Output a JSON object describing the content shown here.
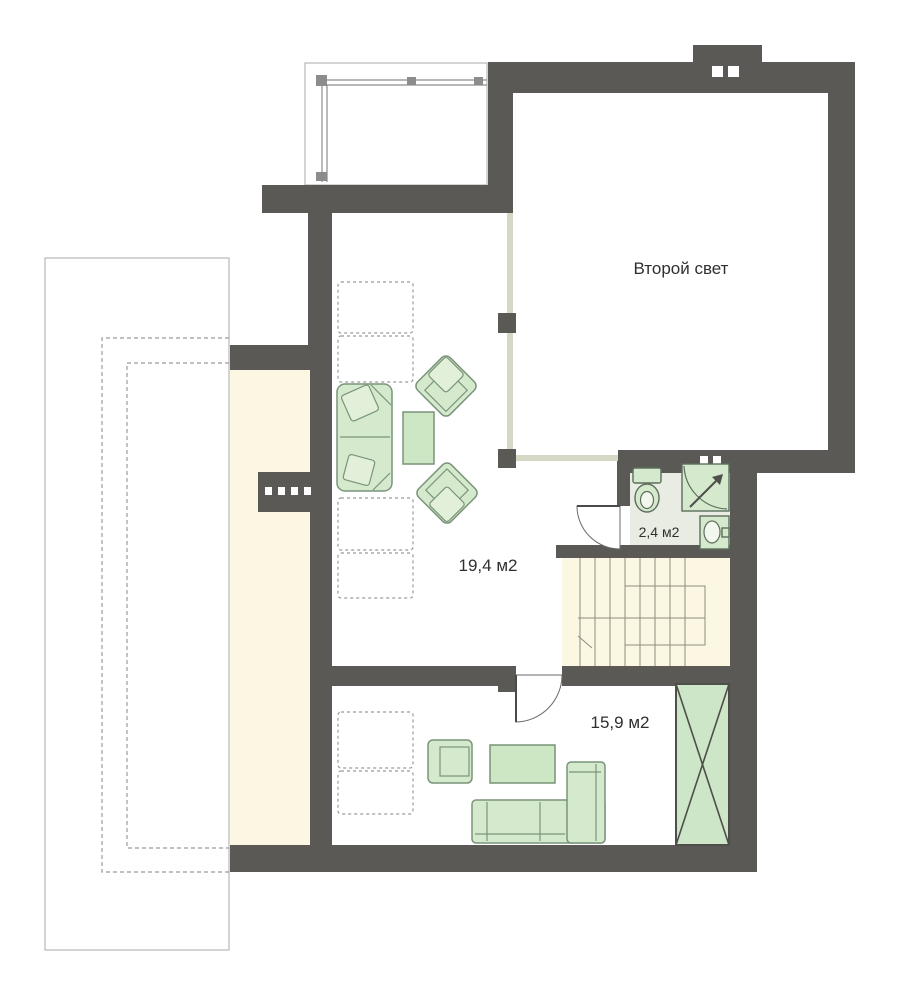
{
  "plan": {
    "title": "Floor plan — second floor",
    "rooms": [
      {
        "name": "second-light",
        "label": "Второй свет"
      },
      {
        "name": "living-room",
        "label": "19,4 м2"
      },
      {
        "name": "bedroom",
        "label": "15,9 м2"
      },
      {
        "name": "bathroom",
        "label": "2,4 м2"
      }
    ],
    "colors": {
      "wall": "#5b5955",
      "floor_cream": "#fbf7e3",
      "bathroom_floor": "#e8ece3",
      "furniture_green": "#d5eacd",
      "furniture_border": "#7a947a",
      "partition_light": "#d6d8c6",
      "background": "#ffffff"
    }
  }
}
